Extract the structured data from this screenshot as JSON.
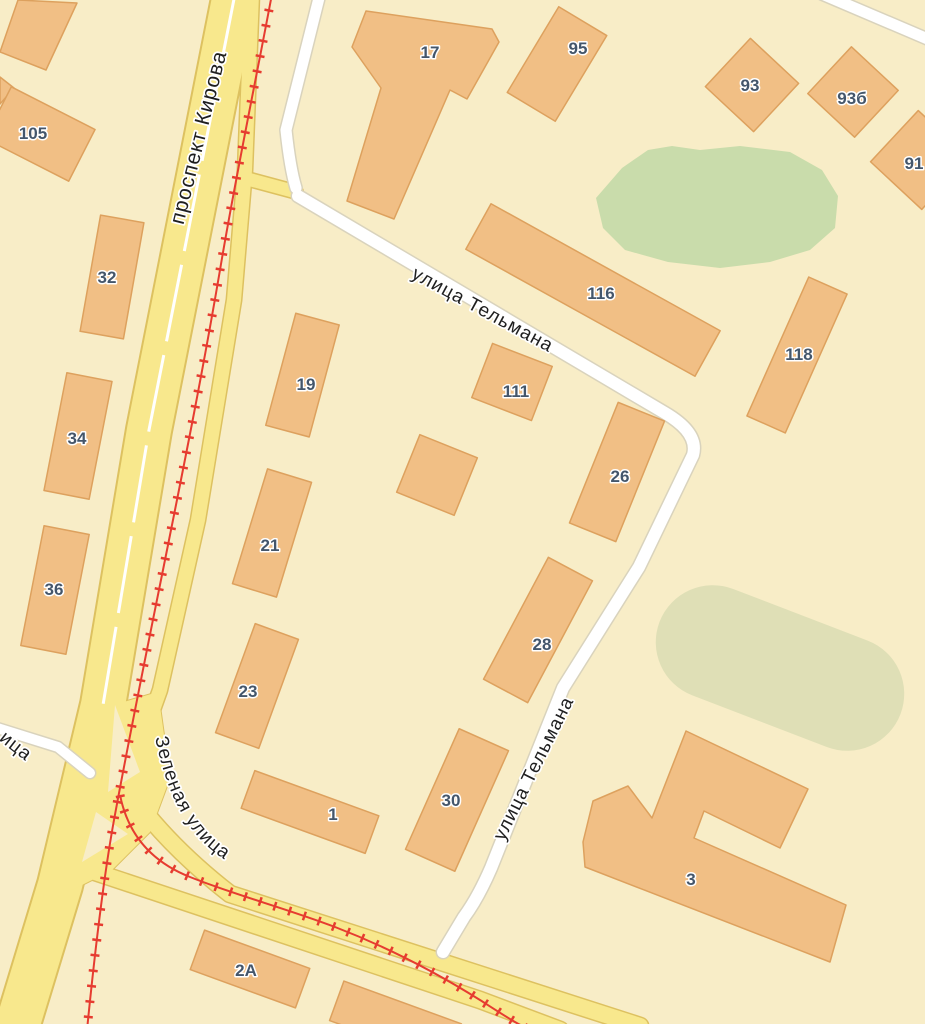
{
  "map": {
    "colors": {
      "bg": "#f8edc7",
      "road_yellow": "#f8e88d",
      "road_yellow_casing": "#ddc160",
      "road_white": "#ffffff",
      "road_white_casing": "#d9d3bd",
      "building_fill": "#f1bf85",
      "building_stroke": "#dda15e",
      "park_green": "#c9dcab",
      "field_olive": "#dfdfb6",
      "tram_red": "#e63c30",
      "street_label": "#1f1f1f",
      "building_label": "#44566b"
    },
    "streets": {
      "kirova": "проспект Кирова",
      "telmana_upper": "улица Тельмана",
      "telmana_lower": "улица Тельмана",
      "zelenaya": "Зеленая улица",
      "partial_left": "ица"
    },
    "building_labels": [
      {
        "label": "105"
      },
      {
        "label": "32"
      },
      {
        "label": "34"
      },
      {
        "label": "36"
      },
      {
        "label": "17"
      },
      {
        "label": "95"
      },
      {
        "label": "93"
      },
      {
        "label": "93б"
      },
      {
        "label": "91"
      },
      {
        "label": "116"
      },
      {
        "label": "118"
      },
      {
        "label": "19"
      },
      {
        "label": "111"
      },
      {
        "label": "26"
      },
      {
        "label": "21"
      },
      {
        "label": "28"
      },
      {
        "label": "23"
      },
      {
        "label": "30"
      },
      {
        "label": "1"
      },
      {
        "label": "3"
      },
      {
        "label": "2А"
      }
    ]
  }
}
